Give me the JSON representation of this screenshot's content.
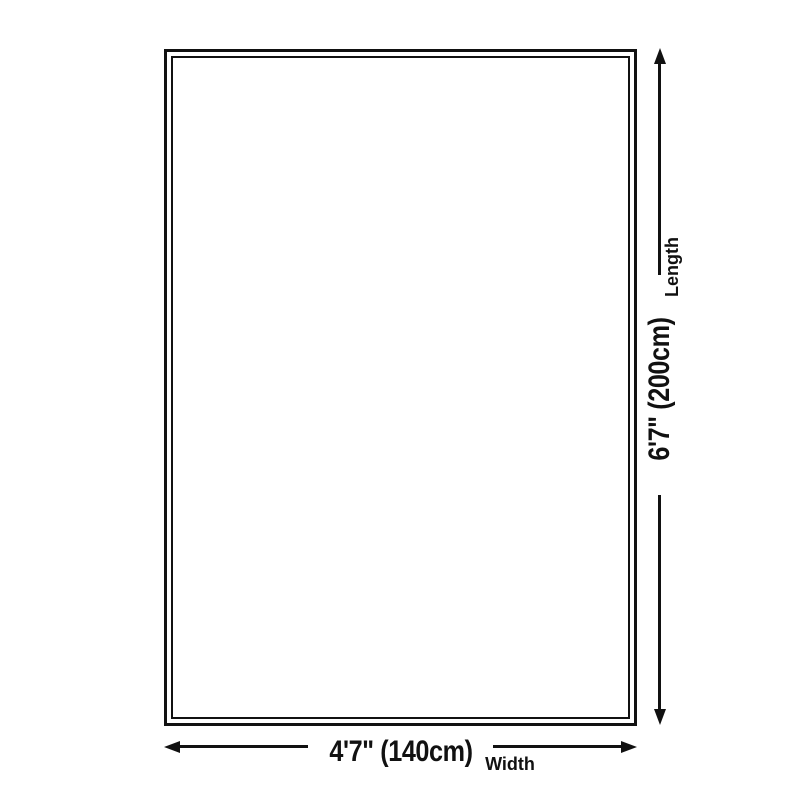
{
  "diagram": {
    "type": "product-size-diagram",
    "length": {
      "value": "6'7\" (200cm)",
      "label": "Length"
    },
    "width": {
      "value": "4'7\" (140cm)",
      "label": "Width"
    },
    "colors": {
      "line": "#111111",
      "text": "#111111",
      "background": "#ffffff"
    }
  }
}
